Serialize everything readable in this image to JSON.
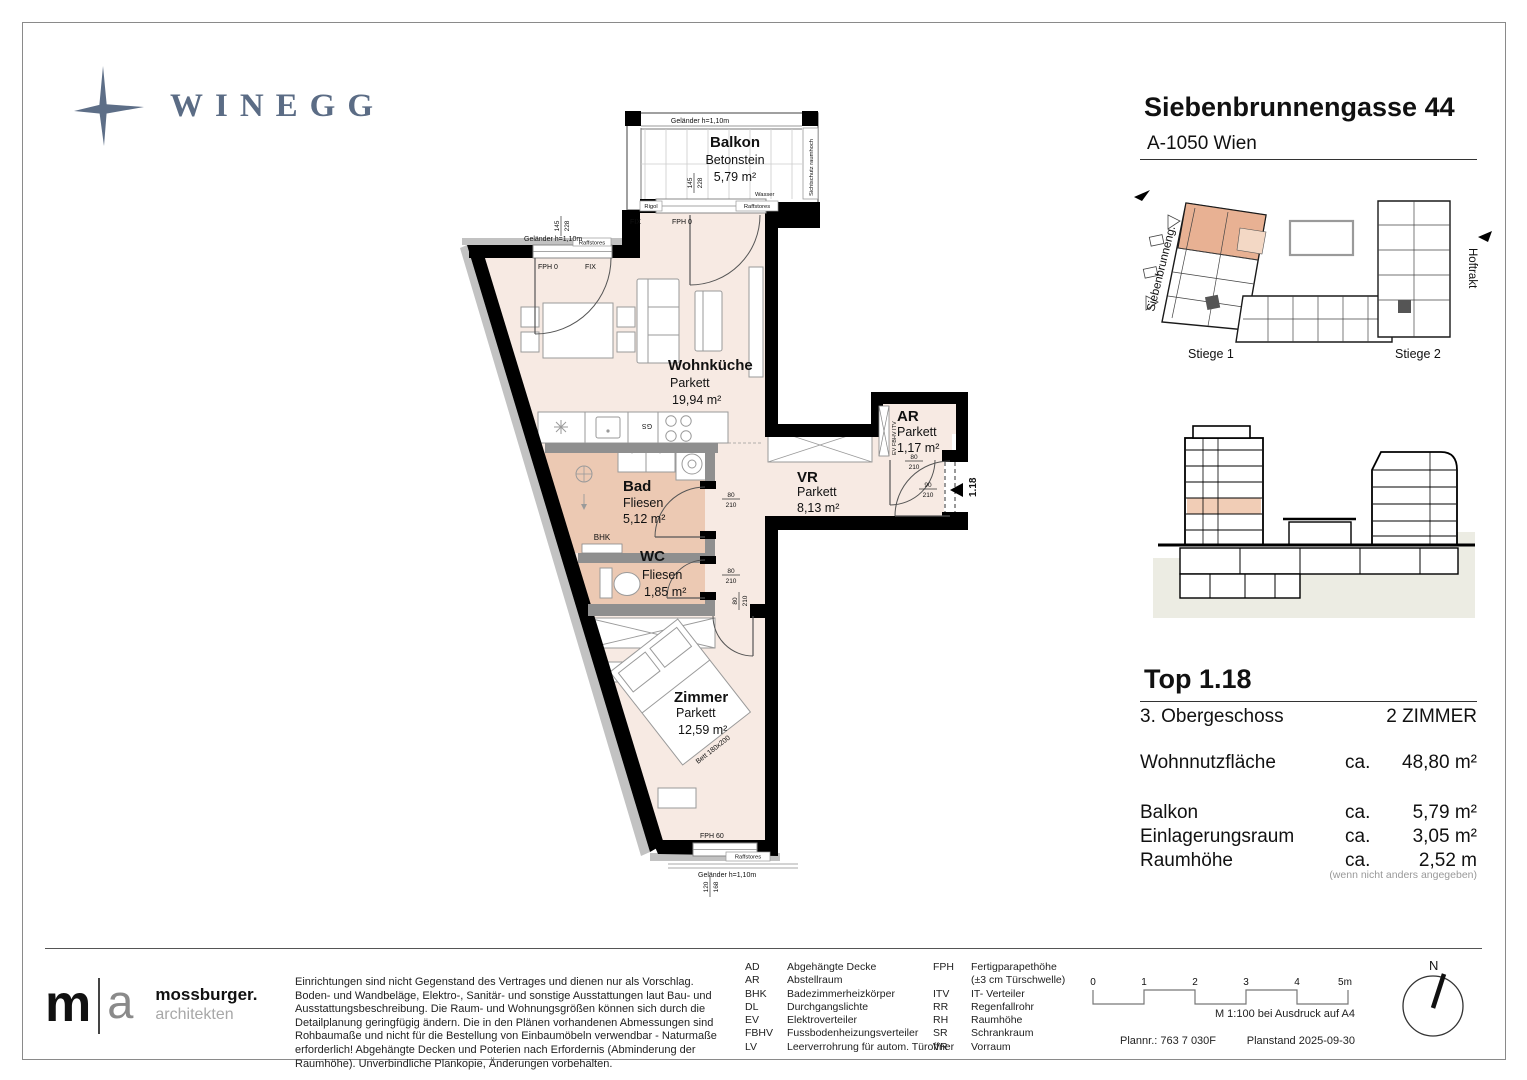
{
  "colors": {
    "brand": "#5b6c85",
    "floor": "#f7eae3",
    "wet_floor": "#ecc9b3",
    "highlight": "#e9b79b"
  },
  "brand": {
    "logo": "WINEGG"
  },
  "project": {
    "title": "Siebenbrunnengasse 44",
    "city": "A-1050 Wien"
  },
  "plan": {
    "rooms": {
      "balkon": {
        "name": "Balkon",
        "finish": "Betonstein",
        "area": "5,79 m²"
      },
      "wohnkueche": {
        "name": "Wohnküche",
        "finish": "Parkett",
        "area": "19,94 m²"
      },
      "bad": {
        "name": "Bad",
        "finish": "Fliesen",
        "area": "5,12 m²"
      },
      "wc": {
        "name": "WC",
        "finish": "Fliesen",
        "area": "1,85 m²"
      },
      "vr": {
        "name": "VR",
        "finish": "Parkett",
        "area": "8,13 m²"
      },
      "ar": {
        "name": "AR",
        "finish": "Parkett",
        "area": "1,17 m²"
      },
      "zimmer": {
        "name": "Zimmer",
        "finish": "Parkett",
        "area": "12,59 m²"
      }
    },
    "ann": {
      "gelaender": "Geländer h=1,10m",
      "sichtschutz": "Sichtschutz raumhoch",
      "wasser": "Wasser",
      "rigol": "Rigol",
      "raffstores": "Raffstores",
      "fix": "FIX",
      "fph0": "FPH 0",
      "fph60": "FPH 60",
      "bhk": "BHK",
      "gs": "GS",
      "bett": "Bett 180x200",
      "unit": "1.18",
      "shaft": "EV FBHV ITV"
    },
    "dims": {
      "win_top": {
        "a": "145",
        "b": "228"
      },
      "door80": {
        "a": "80",
        "b": "210"
      },
      "door90": {
        "a": "90",
        "b": "210"
      },
      "win_bottom": {
        "a": "120",
        "b": "168"
      }
    }
  },
  "sitemap": {
    "stiege1": "Stiege 1",
    "stiege2": "Stiege 2",
    "street": "Siebenbrunneng.",
    "hoftrakt": "Hoftrakt"
  },
  "unit": {
    "top": "Top 1.18",
    "floor": "3. Obergeschoss",
    "rooms": "2 ZIMMER",
    "metrics": [
      {
        "label": "Wohnnutzfläche",
        "ca": "ca.",
        "value": "48,80 m²"
      },
      {
        "label": "Balkon",
        "ca": "ca.",
        "value": "5,79 m²"
      },
      {
        "label": "Einlagerungsraum",
        "ca": "ca.",
        "value": "3,05 m²"
      },
      {
        "label": "Raumhöhe",
        "ca": "ca.",
        "value": "2,52 m"
      }
    ],
    "note": "(wenn nicht anders angegeben)"
  },
  "footer": {
    "architect": {
      "m": "m",
      "a": "a",
      "name": "mossburger.",
      "sub": "architekten"
    },
    "disclaimer": "Einrichtungen sind nicht Gegenstand des Vertrages und dienen nur als Vorschlag. Boden- und Wandbeläge, Elektro-, Sanitär- und sonstige Ausstattungen laut Bau- und Ausstattungsbeschreibung. Die Raum- und Wohnungsgrößen können sich durch die Detailplanung geringfügig ändern. Die in den Plänen vorhandenen Abmessungen sind Rohbaumaße und nicht für die Bestellung von Einbaumöbeln verwendbar - Naturmaße erforderlich! Abgehängte Decken und Poterien nach Erfordernis (Abminderung der Raumhöhe). Unverbindliche Plankopie, Änderungen vorbehalten.",
    "legend_left": [
      {
        "a": "AD",
        "d": "Abgehängte Decke"
      },
      {
        "a": "AR",
        "d": "Abstellraum"
      },
      {
        "a": "BHK",
        "d": "Badezimmerheizkörper"
      },
      {
        "a": "DL",
        "d": "Durchgangslichte"
      },
      {
        "a": "EV",
        "d": "Elektroverteiler"
      },
      {
        "a": "FBHV",
        "d": "Fussbodenheizungsverteiler"
      },
      {
        "a": "LV",
        "d": "Leerverrohrung für autom. Türoffner"
      }
    ],
    "legend_right": [
      {
        "a": "FPH",
        "d": "Fertigparapethöhe"
      },
      {
        "a": "",
        "d": "(±3 cm Türschwelle)"
      },
      {
        "a": "ITV",
        "d": "IT- Verteiler"
      },
      {
        "a": "RR",
        "d": "Regenfallrohr"
      },
      {
        "a": "RH",
        "d": "Raumhöhe"
      },
      {
        "a": "SR",
        "d": "Schrankraum"
      },
      {
        "a": "VR",
        "d": "Vorraum"
      }
    ],
    "scale": {
      "t0": "0",
      "t1": "1",
      "t2": "2",
      "t3": "3",
      "t4": "4",
      "t5": "5m",
      "note": "M 1:100 bei Ausdruck auf A4"
    },
    "plannr": "Plannr.: 763 7 030F",
    "planstand": "Planstand 2025-09-30",
    "north": "N"
  }
}
